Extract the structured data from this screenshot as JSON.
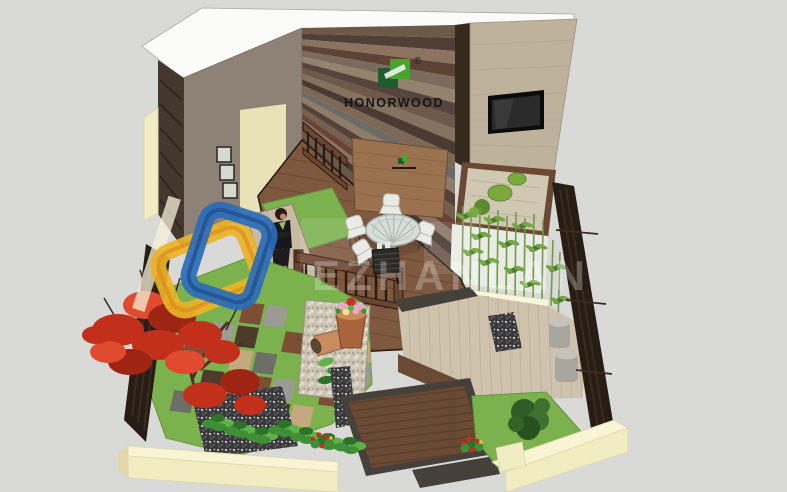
{
  "meta": {
    "description": "Isometric 3D SketchUp-style render of an outdoor WPC decking showroom garden with multicolor plank feature wall, zen sand garden, bamboo planter, dining set, red maple and tiled lawn"
  },
  "brand": {
    "name": "HONORWOOD",
    "registered_mark": "®"
  },
  "watermark": {
    "latin_fragment": "EZHANLAN"
  },
  "scene_elements": [
    "wood-plank-feature-wall",
    "honorwood-wall-logo",
    "interior-gray-wall",
    "cream-door-panel",
    "picture-frames",
    "wall-mounted-tv",
    "tan-accent-wall",
    "zen-sand-garden",
    "moss-circles",
    "bamboo-planter",
    "white-privacy-screen",
    "cushion-bench",
    "gray-poufs",
    "outdoor-dining-set",
    "wood-privacy-panel",
    "grill-cart",
    "deck-railing",
    "standing-woman",
    "light-deck-strip",
    "grass-patches",
    "deck-tile-checkerboard",
    "pebble-path",
    "dark-pebble-mulch",
    "terracotta-flower-pot",
    "lying-clay-pot",
    "hosta-border",
    "red-flower-bushes",
    "green-shrub",
    "japanese-red-maple",
    "dark-wood-fences",
    "cream-perimeter-walls",
    "wood-deck-platform",
    "wood-steps",
    "watermark-logo",
    "watermark-text"
  ],
  "colors": {
    "bg": "#d9d9d8",
    "roofWhite": "#fbfbfa",
    "roofEdge": "#a9a9a6",
    "plankEdgeDark": "#352a20",
    "wallGray": "#8e8175",
    "wallGrayShade": "#7b6f64",
    "doorCream": "#e9e2b6",
    "frameFill": "#d8d8d0",
    "frameEdge": "#30302e",
    "sideDark": "#44382e",
    "sideHatch": "#2f261e",
    "outerCream": "#f2ecc2",
    "outerCreamTop": "#f8f4d4",
    "outerCreamShade": "#e0d8aa",
    "tanWall": "#bfb29c",
    "tanLine": "#a99c86",
    "tvBlack": "#0b0b0b",
    "tvScreen": "#2a2a2a",
    "sand": "#d1c8b4",
    "sandLine": "#bdb29b",
    "moss": "#7aa93e",
    "mossDark": "#5c8a2e",
    "zenFrame": "#6b4832",
    "screenWhite": "#ebebe6",
    "bambooStem": "#6f9c4c",
    "bambooLeaf": "#4e7c2e",
    "bambooLeafLight": "#74a743",
    "planterCream": "#f3eecb",
    "planterTop": "#fbf7dd",
    "cushionGray": "#b8b6ae",
    "cushionEdge": "#8e8c84",
    "poufGray": "#a9a79d",
    "poufTop": "#c6c4ba",
    "deckBrown": "#7e583f",
    "deckLine": "#5e3e2c",
    "deckDark": "#6a4733",
    "lightStrip": "#c8bba4",
    "lightStripLine": "#b2a48c",
    "deckLight": "#cfc3ae",
    "deckLightLine": "#b9ac94",
    "stepCharcoal": "#46403a",
    "platformBrown": "#6b4a35",
    "platformLine": "#543a26",
    "grass": "#7cb24e",
    "grassDark": "#63973f",
    "tileGray": "#9b9b94",
    "tileBrown": "#7c4f34",
    "tileTan": "#c4a87e",
    "tileDark": "#4e3a2b",
    "tileSlate": "#6e6e68",
    "pebbleLight": "#ccc4b4",
    "pebbleDot1": "#a99f8c",
    "pebbleDot2": "#e6dfd1",
    "pebbleDark": "#39383a",
    "pebbleDarkDot1": "#cfcfcf",
    "pebbleDarkDot2": "#6f6f71",
    "maple": "#c2301c",
    "mapleDark": "#9e2414",
    "mapleLight": "#e04a2e",
    "trunk": "#4a3226",
    "fenceDark": "#281d14",
    "fenceSlat": "#3b2c1e",
    "railWood": "#6a4530",
    "railDark": "#2a1a10",
    "hosta": "#3f8f37",
    "hostaLight": "#5fb249",
    "hostaDark": "#2e7227",
    "flowerRed": "#cf2a22",
    "flowerYellow": "#e8c23a",
    "flowerPink": "#e8a7c4",
    "potClay": "#a9643c",
    "potClayLight": "#c98c5e",
    "tableGlass": "#d7ded9",
    "tableEdge": "#a7b0aa",
    "chairWhite": "#eaeae7",
    "chairEdge": "#b9b9b3",
    "metalDark": "#3c3c3c",
    "grillDark": "#2b2a28",
    "grillSlat": "#4b4a47",
    "skin": "#c08a62",
    "hairBrown": "#2c1b16",
    "suitBlack": "#17161a",
    "blouseGreen": "#9db86a",
    "screenWood": "#9a7250",
    "screenWoodLine": "#7d5a3c",
    "brandGreen": "#45a52d",
    "brandGreenDark": "#1c5c2e",
    "logoText": "#161616",
    "wmBlue": "#2b6cb8",
    "wmBlueDark": "#1b4c8c",
    "wmYellow": "#eab427",
    "wmOrange": "#e08a1e",
    "wmBeam": "#f5f0d8",
    "plank0": "#6d5948",
    "plank1": "#4f3f35",
    "plank2": "#8a7360",
    "plank3": "#5c4336",
    "plank4": "#7b6a5e",
    "plank5": "#93826e",
    "plank6": "#55453c",
    "plank7": "#6e584a",
    "plank8": "#847160",
    "plank9": "#4a3a32",
    "plank10": "#7d6755",
    "plank11": "#6e6a66",
    "plank12": "#8e7c66",
    "plank13": "#53413a",
    "plank14": "#756050",
    "plank15": "#6a4336",
    "plank16": "#887462",
    "plank17": "#49382e",
    "plank18": "#6b564a",
    "plank19": "#584840"
  }
}
